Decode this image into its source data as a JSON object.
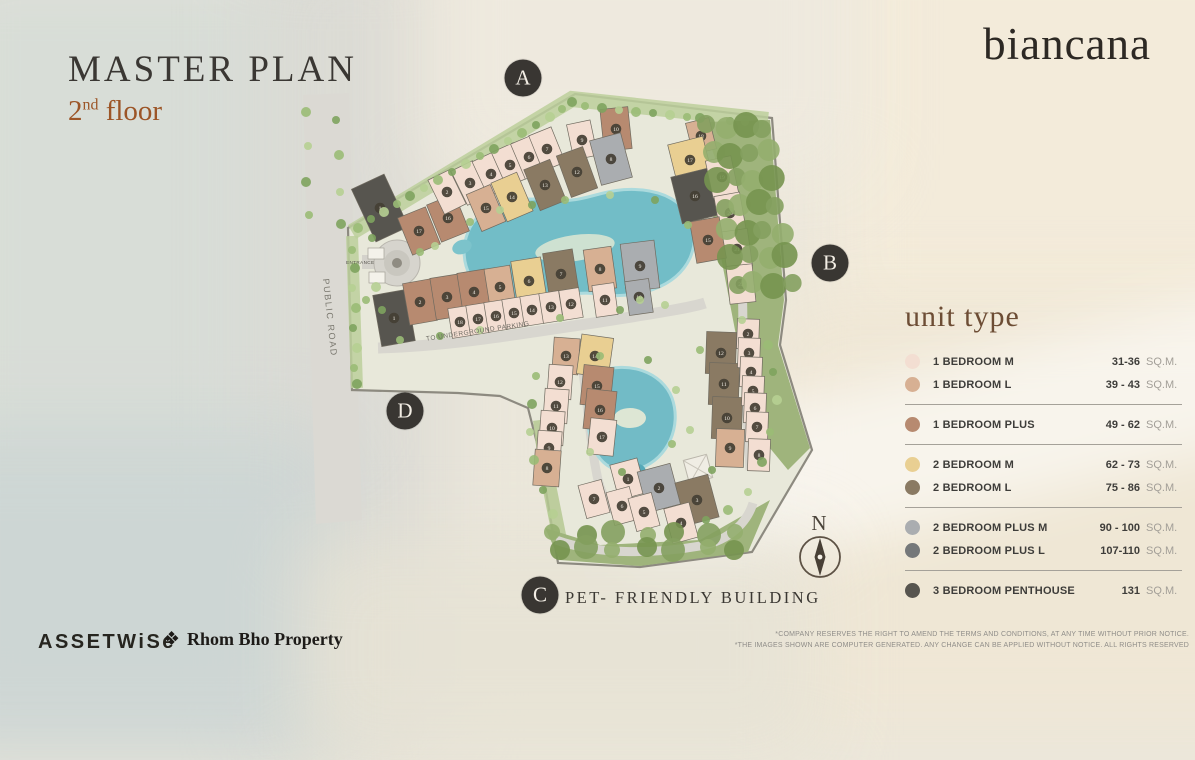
{
  "header": {
    "title": "MASTER PLAN",
    "floor_num": "2",
    "floor_sup": "nd",
    "floor_word": " floor",
    "brand": "biancana"
  },
  "legend": {
    "title": "unit type",
    "unit_label": "SQ.M.",
    "groups": [
      [
        {
          "key": "1br-m",
          "label": "1 BEDROOM M",
          "range": "31-36"
        },
        {
          "key": "1br-l",
          "label": "1 BEDROOM L",
          "range": "39 - 43"
        }
      ],
      [
        {
          "key": "1br-plus",
          "label": "1 BEDROOM PLUS",
          "range": "49 - 62"
        }
      ],
      [
        {
          "key": "2br-m",
          "label": "2 BEDROOM M",
          "range": "62 - 73"
        },
        {
          "key": "2br-l",
          "label": "2 BEDROOM L",
          "range": "75 - 86"
        }
      ],
      [
        {
          "key": "2br-plus-m",
          "label": "2 BEDROOM PLUS M",
          "range": "90 - 100"
        },
        {
          "key": "2br-plus-l",
          "label": "2 BEDROOM PLUS L",
          "range": "107-110"
        }
      ],
      [
        {
          "key": "penthouse",
          "label": "3 BEDROOM PENTHOUSE",
          "range": "131"
        }
      ]
    ]
  },
  "unit_colors": {
    "1br-m": "#f3ded2",
    "1br-l": "#d7b093",
    "1br-plus": "#b78a70",
    "2br-m": "#e9cf92",
    "2br-l": "#8a7a63",
    "2br-plus-m": "#aaadb0",
    "2br-plus-l": "#75787a",
    "penthouse": "#57554f"
  },
  "map": {
    "markers": [
      {
        "label": "A",
        "x": 523,
        "y": 78
      },
      {
        "label": "B",
        "x": 830,
        "y": 263
      },
      {
        "label": "C",
        "x": 540,
        "y": 595
      },
      {
        "label": "D",
        "x": 405,
        "y": 411
      }
    ],
    "pet_note": "PET- FRIENDLY BUILDING",
    "compass_label": "N",
    "road_label": "PUBLIC ROAD",
    "entrance_label": "ENTRANCE",
    "parking_label": "TO UNDERGROUND PARKING",
    "buildings": [
      {
        "n": "1",
        "t": "penthouse",
        "x": 380,
        "y": 208,
        "w": 36,
        "h": 58,
        "r": -25
      },
      {
        "n": "17",
        "t": "1br-plus",
        "x": 419,
        "y": 231,
        "w": 30,
        "h": 40,
        "r": -22
      },
      {
        "n": "16",
        "t": "1br-plus",
        "x": 448,
        "y": 218,
        "w": 30,
        "h": 40,
        "r": -22
      },
      {
        "n": "2",
        "t": "1br-m",
        "x": 447,
        "y": 192,
        "w": 24,
        "h": 38,
        "r": -26
      },
      {
        "n": "3",
        "t": "1br-m",
        "x": 470,
        "y": 183,
        "w": 24,
        "h": 38,
        "r": -26
      },
      {
        "n": "4",
        "t": "1br-m",
        "x": 491,
        "y": 174,
        "w": 24,
        "h": 38,
        "r": -25
      },
      {
        "n": "5",
        "t": "1br-m",
        "x": 510,
        "y": 165,
        "w": 24,
        "h": 38,
        "r": -24
      },
      {
        "n": "6",
        "t": "1br-m",
        "x": 529,
        "y": 157,
        "w": 24,
        "h": 38,
        "r": -23
      },
      {
        "n": "7",
        "t": "1br-m",
        "x": 547,
        "y": 149,
        "w": 24,
        "h": 38,
        "r": -22
      },
      {
        "n": "9",
        "t": "1br-m",
        "x": 582,
        "y": 140,
        "w": 24,
        "h": 36,
        "r": -12
      },
      {
        "n": "10",
        "t": "1br-plus",
        "x": 616,
        "y": 129,
        "w": 28,
        "h": 42,
        "r": -6
      },
      {
        "n": "15",
        "t": "1br-l",
        "x": 486,
        "y": 208,
        "w": 26,
        "h": 40,
        "r": -23
      },
      {
        "n": "14",
        "t": "2br-m",
        "x": 512,
        "y": 197,
        "w": 28,
        "h": 42,
        "r": -23
      },
      {
        "n": "13",
        "t": "2br-l",
        "x": 545,
        "y": 185,
        "w": 28,
        "h": 44,
        "r": -22
      },
      {
        "n": "12",
        "t": "2br-l",
        "x": 577,
        "y": 172,
        "w": 28,
        "h": 44,
        "r": -20
      },
      {
        "n": "8",
        "t": "2br-plus-m",
        "x": 611,
        "y": 159,
        "w": 32,
        "h": 46,
        "r": -15
      },
      {
        "n": "18",
        "t": "1br-l",
        "x": 701,
        "y": 136,
        "w": 24,
        "h": 32,
        "r": -14
      },
      {
        "n": "17",
        "t": "2br-m",
        "x": 690,
        "y": 160,
        "w": 36,
        "h": 40,
        "r": -14
      },
      {
        "n": "16",
        "t": "penthouse",
        "x": 695,
        "y": 196,
        "w": 38,
        "h": 48,
        "r": -14
      },
      {
        "n": "19",
        "t": "1br-m",
        "x": 722,
        "y": 177,
        "w": 26,
        "h": 38,
        "r": -12
      },
      {
        "n": "20",
        "t": "1br-m",
        "x": 730,
        "y": 213,
        "w": 26,
        "h": 38,
        "r": -10
      },
      {
        "n": "21",
        "t": "1br-m",
        "x": 737,
        "y": 249,
        "w": 26,
        "h": 38,
        "r": -8
      },
      {
        "n": "22",
        "t": "1br-m",
        "x": 741,
        "y": 284,
        "w": 26,
        "h": 38,
        "r": -6
      },
      {
        "n": "15",
        "t": "1br-plus",
        "x": 708,
        "y": 240,
        "w": 30,
        "h": 42,
        "r": -10
      },
      {
        "n": "1",
        "t": "penthouse",
        "x": 394,
        "y": 318,
        "w": 34,
        "h": 52,
        "r": -10
      },
      {
        "n": "2",
        "t": "1br-plus",
        "x": 420,
        "y": 302,
        "w": 28,
        "h": 42,
        "r": -10
      },
      {
        "n": "3",
        "t": "1br-plus",
        "x": 447,
        "y": 297,
        "w": 28,
        "h": 42,
        "r": -9
      },
      {
        "n": "4",
        "t": "1br-plus",
        "x": 474,
        "y": 292,
        "w": 28,
        "h": 42,
        "r": -9
      },
      {
        "n": "5",
        "t": "1br-l",
        "x": 500,
        "y": 287,
        "w": 26,
        "h": 40,
        "r": -9
      },
      {
        "n": "6",
        "t": "2br-m",
        "x": 529,
        "y": 281,
        "w": 30,
        "h": 44,
        "r": -9
      },
      {
        "n": "7",
        "t": "2br-l",
        "x": 561,
        "y": 274,
        "w": 30,
        "h": 46,
        "r": -9
      },
      {
        "n": "8",
        "t": "1br-l",
        "x": 600,
        "y": 269,
        "w": 28,
        "h": 42,
        "r": -8
      },
      {
        "n": "9",
        "t": "2br-plus-m",
        "x": 640,
        "y": 266,
        "w": 34,
        "h": 48,
        "r": -7
      },
      {
        "n": "18",
        "t": "1br-m",
        "x": 460,
        "y": 322,
        "w": 20,
        "h": 30,
        "r": -9
      },
      {
        "n": "17",
        "t": "1br-m",
        "x": 478,
        "y": 319,
        "w": 20,
        "h": 30,
        "r": -9
      },
      {
        "n": "16",
        "t": "1br-m",
        "x": 496,
        "y": 316,
        "w": 20,
        "h": 30,
        "r": -9
      },
      {
        "n": "15",
        "t": "1br-m",
        "x": 514,
        "y": 313,
        "w": 20,
        "h": 30,
        "r": -9
      },
      {
        "n": "14",
        "t": "1br-m",
        "x": 532,
        "y": 310,
        "w": 20,
        "h": 30,
        "r": -9
      },
      {
        "n": "13",
        "t": "1br-m",
        "x": 551,
        "y": 307,
        "w": 20,
        "h": 30,
        "r": -9
      },
      {
        "n": "12",
        "t": "1br-m",
        "x": 571,
        "y": 304,
        "w": 20,
        "h": 30,
        "r": -9
      },
      {
        "n": "11",
        "t": "1br-m",
        "x": 605,
        "y": 300,
        "w": 22,
        "h": 32,
        "r": -8
      },
      {
        "n": "10",
        "t": "2br-plus-m",
        "x": 639,
        "y": 297,
        "w": 24,
        "h": 34,
        "r": -8
      },
      {
        "n": "13",
        "t": "1br-l",
        "x": 566,
        "y": 356,
        "w": 26,
        "h": 36,
        "r": 4
      },
      {
        "n": "12",
        "t": "1br-m",
        "x": 560,
        "y": 382,
        "w": 24,
        "h": 34,
        "r": 4
      },
      {
        "n": "11",
        "t": "1br-m",
        "x": 556,
        "y": 406,
        "w": 24,
        "h": 34,
        "r": 4
      },
      {
        "n": "10",
        "t": "1br-m",
        "x": 552,
        "y": 428,
        "w": 24,
        "h": 34,
        "r": 4
      },
      {
        "n": "9",
        "t": "1br-m",
        "x": 549,
        "y": 448,
        "w": 24,
        "h": 34,
        "r": 4
      },
      {
        "n": "8",
        "t": "1br-l",
        "x": 547,
        "y": 468,
        "w": 26,
        "h": 36,
        "r": 4
      },
      {
        "n": "14",
        "t": "2br-m",
        "x": 595,
        "y": 356,
        "w": 32,
        "h": 40,
        "r": 8
      },
      {
        "n": "15",
        "t": "1br-plus",
        "x": 597,
        "y": 386,
        "w": 30,
        "h": 40,
        "r": 6
      },
      {
        "n": "16",
        "t": "1br-plus",
        "x": 600,
        "y": 410,
        "w": 30,
        "h": 40,
        "r": 6
      },
      {
        "n": "17",
        "t": "1br-m",
        "x": 602,
        "y": 437,
        "w": 26,
        "h": 36,
        "r": 6
      },
      {
        "n": "1",
        "t": "1br-m",
        "x": 628,
        "y": 479,
        "w": 28,
        "h": 36,
        "r": -15
      },
      {
        "n": "2",
        "t": "2br-plus-m",
        "x": 659,
        "y": 488,
        "w": 34,
        "h": 42,
        "r": -15
      },
      {
        "n": "3",
        "t": "2br-l",
        "x": 697,
        "y": 500,
        "w": 34,
        "h": 44,
        "r": -15
      },
      {
        "n": "7",
        "t": "1br-m",
        "x": 594,
        "y": 499,
        "w": 24,
        "h": 34,
        "r": -15
      },
      {
        "n": "6",
        "t": "1br-m",
        "x": 622,
        "y": 506,
        "w": 24,
        "h": 34,
        "r": -15
      },
      {
        "n": "5",
        "t": "1br-m",
        "x": 644,
        "y": 512,
        "w": 24,
        "h": 34,
        "r": -15
      },
      {
        "n": "4",
        "t": "1br-m",
        "x": 681,
        "y": 523,
        "w": 26,
        "h": 36,
        "r": -15
      },
      {
        "n": "12",
        "t": "2br-l",
        "x": 721,
        "y": 353,
        "w": 30,
        "h": 42,
        "r": 2
      },
      {
        "n": "11",
        "t": "2br-l",
        "x": 724,
        "y": 384,
        "w": 30,
        "h": 42,
        "r": 2
      },
      {
        "n": "10",
        "t": "2br-l",
        "x": 727,
        "y": 418,
        "w": 30,
        "h": 42,
        "r": 2
      },
      {
        "n": "9",
        "t": "1br-l",
        "x": 730,
        "y": 448,
        "w": 28,
        "h": 38,
        "r": 2
      },
      {
        "n": "2",
        "t": "1br-m",
        "x": 748,
        "y": 334,
        "w": 22,
        "h": 30,
        "r": 2
      },
      {
        "n": "3",
        "t": "1br-m",
        "x": 749,
        "y": 353,
        "w": 22,
        "h": 30,
        "r": 2
      },
      {
        "n": "4",
        "t": "1br-m",
        "x": 751,
        "y": 372,
        "w": 22,
        "h": 30,
        "r": 2
      },
      {
        "n": "5",
        "t": "1br-m",
        "x": 753,
        "y": 391,
        "w": 22,
        "h": 30,
        "r": 2
      },
      {
        "n": "6",
        "t": "1br-m",
        "x": 755,
        "y": 408,
        "w": 22,
        "h": 30,
        "r": 2
      },
      {
        "n": "7",
        "t": "1br-m",
        "x": 757,
        "y": 427,
        "w": 22,
        "h": 30,
        "r": 2
      },
      {
        "n": "8",
        "t": "1br-m",
        "x": 759,
        "y": 455,
        "w": 22,
        "h": 32,
        "r": 2
      }
    ]
  },
  "footer": {
    "assetwise": "ASSETWiSe",
    "partner_icon": "❖",
    "partner": "Rhom Bho Property",
    "disclaimer_line1": "*COMPANY RESERVES THE RIGHT TO AMEND THE TERMS AND CONDITIONS, AT ANY TIME WITHOUT PRIOR NOTICE.",
    "disclaimer_line2": "*THE IMAGES SHOWN ARE COMPUTER GENERATED. ANY CHANGE CAN BE APPLIED WITHOUT NOTICE. ALL RIGHTS RESERVED"
  }
}
